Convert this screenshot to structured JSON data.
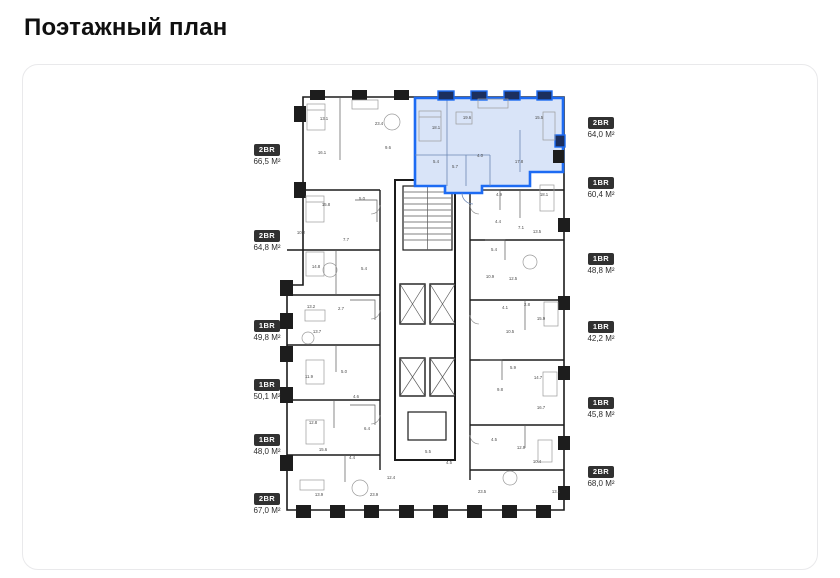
{
  "page": {
    "title": "Поэтажный план"
  },
  "floor_plan": {
    "left_units": [
      {
        "type": "2BR",
        "area": "66,5 М²",
        "y": 140
      },
      {
        "type": "2BR",
        "area": "64,8 М²",
        "y": 226
      },
      {
        "type": "1BR",
        "area": "49,8 М²",
        "y": 316
      },
      {
        "type": "1BR",
        "area": "50,1 М²",
        "y": 375
      },
      {
        "type": "1BR",
        "area": "48,0 М²",
        "y": 430
      },
      {
        "type": "2BR",
        "area": "67,0 М²",
        "y": 489
      }
    ],
    "right_units": [
      {
        "type": "2BR",
        "area": "64,0 М²",
        "y": 113,
        "highlighted": true
      },
      {
        "type": "1BR",
        "area": "60,4 М²",
        "y": 173,
        "highlighted": false
      },
      {
        "type": "1BR",
        "area": "48,8 М²",
        "y": 249,
        "highlighted": false
      },
      {
        "type": "1BR",
        "area": "42,2 М²",
        "y": 317,
        "highlighted": false
      },
      {
        "type": "1BR",
        "area": "45,8 М²",
        "y": 393,
        "highlighted": false
      },
      {
        "type": "2BR",
        "area": "68,0 М²",
        "y": 462,
        "highlighted": false
      }
    ],
    "highlighted_unit": {
      "type": "2BR",
      "area": "64,0 М²",
      "rooms": [
        "18.1",
        "19.6",
        "15.5",
        "4.0",
        "5.7",
        "5.4"
      ]
    },
    "room_labels": [
      {
        "t": "13.1",
        "x": 324,
        "y": 120
      },
      {
        "t": "23.4",
        "x": 379,
        "y": 125
      },
      {
        "t": "16.1",
        "x": 322,
        "y": 154
      },
      {
        "t": "9.6",
        "x": 388,
        "y": 149
      },
      {
        "t": "15.8",
        "x": 326,
        "y": 206
      },
      {
        "t": "10.2",
        "x": 301,
        "y": 234
      },
      {
        "t": "7.7",
        "x": 346,
        "y": 241
      },
      {
        "t": "5.0",
        "x": 362,
        "y": 200
      },
      {
        "t": "14.8",
        "x": 316,
        "y": 268
      },
      {
        "t": "5.4",
        "x": 364,
        "y": 270
      },
      {
        "t": "13.2",
        "x": 311,
        "y": 308
      },
      {
        "t": "2.7",
        "x": 341,
        "y": 310
      },
      {
        "t": "13.7",
        "x": 317,
        "y": 333
      },
      {
        "t": "11.9",
        "x": 309,
        "y": 378
      },
      {
        "t": "5.0",
        "x": 344,
        "y": 373
      },
      {
        "t": "4.6",
        "x": 356,
        "y": 398
      },
      {
        "t": "12.8",
        "x": 313,
        "y": 424
      },
      {
        "t": "15.6",
        "x": 323,
        "y": 451
      },
      {
        "t": "4.4",
        "x": 352,
        "y": 459
      },
      {
        "t": "6.4",
        "x": 367,
        "y": 430
      },
      {
        "t": "12.4",
        "x": 391,
        "y": 479
      },
      {
        "t": "13.9",
        "x": 319,
        "y": 496
      },
      {
        "t": "23.9",
        "x": 374,
        "y": 496
      },
      {
        "t": "5.5",
        "x": 428,
        "y": 453
      },
      {
        "t": "4.5",
        "x": 449,
        "y": 464
      },
      {
        "t": "18.1",
        "x": 436,
        "y": 129
      },
      {
        "t": "19.6",
        "x": 467,
        "y": 119
      },
      {
        "t": "15.5",
        "x": 539,
        "y": 119
      },
      {
        "t": "4.0",
        "x": 480,
        "y": 157
      },
      {
        "t": "5.7",
        "x": 455,
        "y": 168
      },
      {
        "t": "5.4",
        "x": 436,
        "y": 163
      },
      {
        "t": "17.8",
        "x": 519,
        "y": 163
      },
      {
        "t": "18.1",
        "x": 544,
        "y": 196
      },
      {
        "t": "4.9",
        "x": 499,
        "y": 196
      },
      {
        "t": "4.4",
        "x": 498,
        "y": 223
      },
      {
        "t": "7.1",
        "x": 521,
        "y": 229
      },
      {
        "t": "13.5",
        "x": 537,
        "y": 233
      },
      {
        "t": "5.4",
        "x": 494,
        "y": 251
      },
      {
        "t": "10.9",
        "x": 490,
        "y": 278
      },
      {
        "t": "12.5",
        "x": 513,
        "y": 280
      },
      {
        "t": "4.1",
        "x": 505,
        "y": 309
      },
      {
        "t": "2.8",
        "x": 527,
        "y": 306
      },
      {
        "t": "10.5",
        "x": 510,
        "y": 333
      },
      {
        "t": "15.9",
        "x": 541,
        "y": 320
      },
      {
        "t": "5.9",
        "x": 513,
        "y": 369
      },
      {
        "t": "14.7",
        "x": 538,
        "y": 379
      },
      {
        "t": "9.8",
        "x": 500,
        "y": 391
      },
      {
        "t": "16.7",
        "x": 541,
        "y": 409
      },
      {
        "t": "4.5",
        "x": 494,
        "y": 441
      },
      {
        "t": "12.9",
        "x": 521,
        "y": 449
      },
      {
        "t": "10.4",
        "x": 537,
        "y": 463
      },
      {
        "t": "23.5",
        "x": 482,
        "y": 493
      },
      {
        "t": "13.1",
        "x": 556,
        "y": 493
      }
    ],
    "colors": {
      "highlight": "#1d6bf3",
      "highlight_fill": "#d9e4f8",
      "wall": "#1b1b1b",
      "badge_bg": "#313131"
    }
  }
}
